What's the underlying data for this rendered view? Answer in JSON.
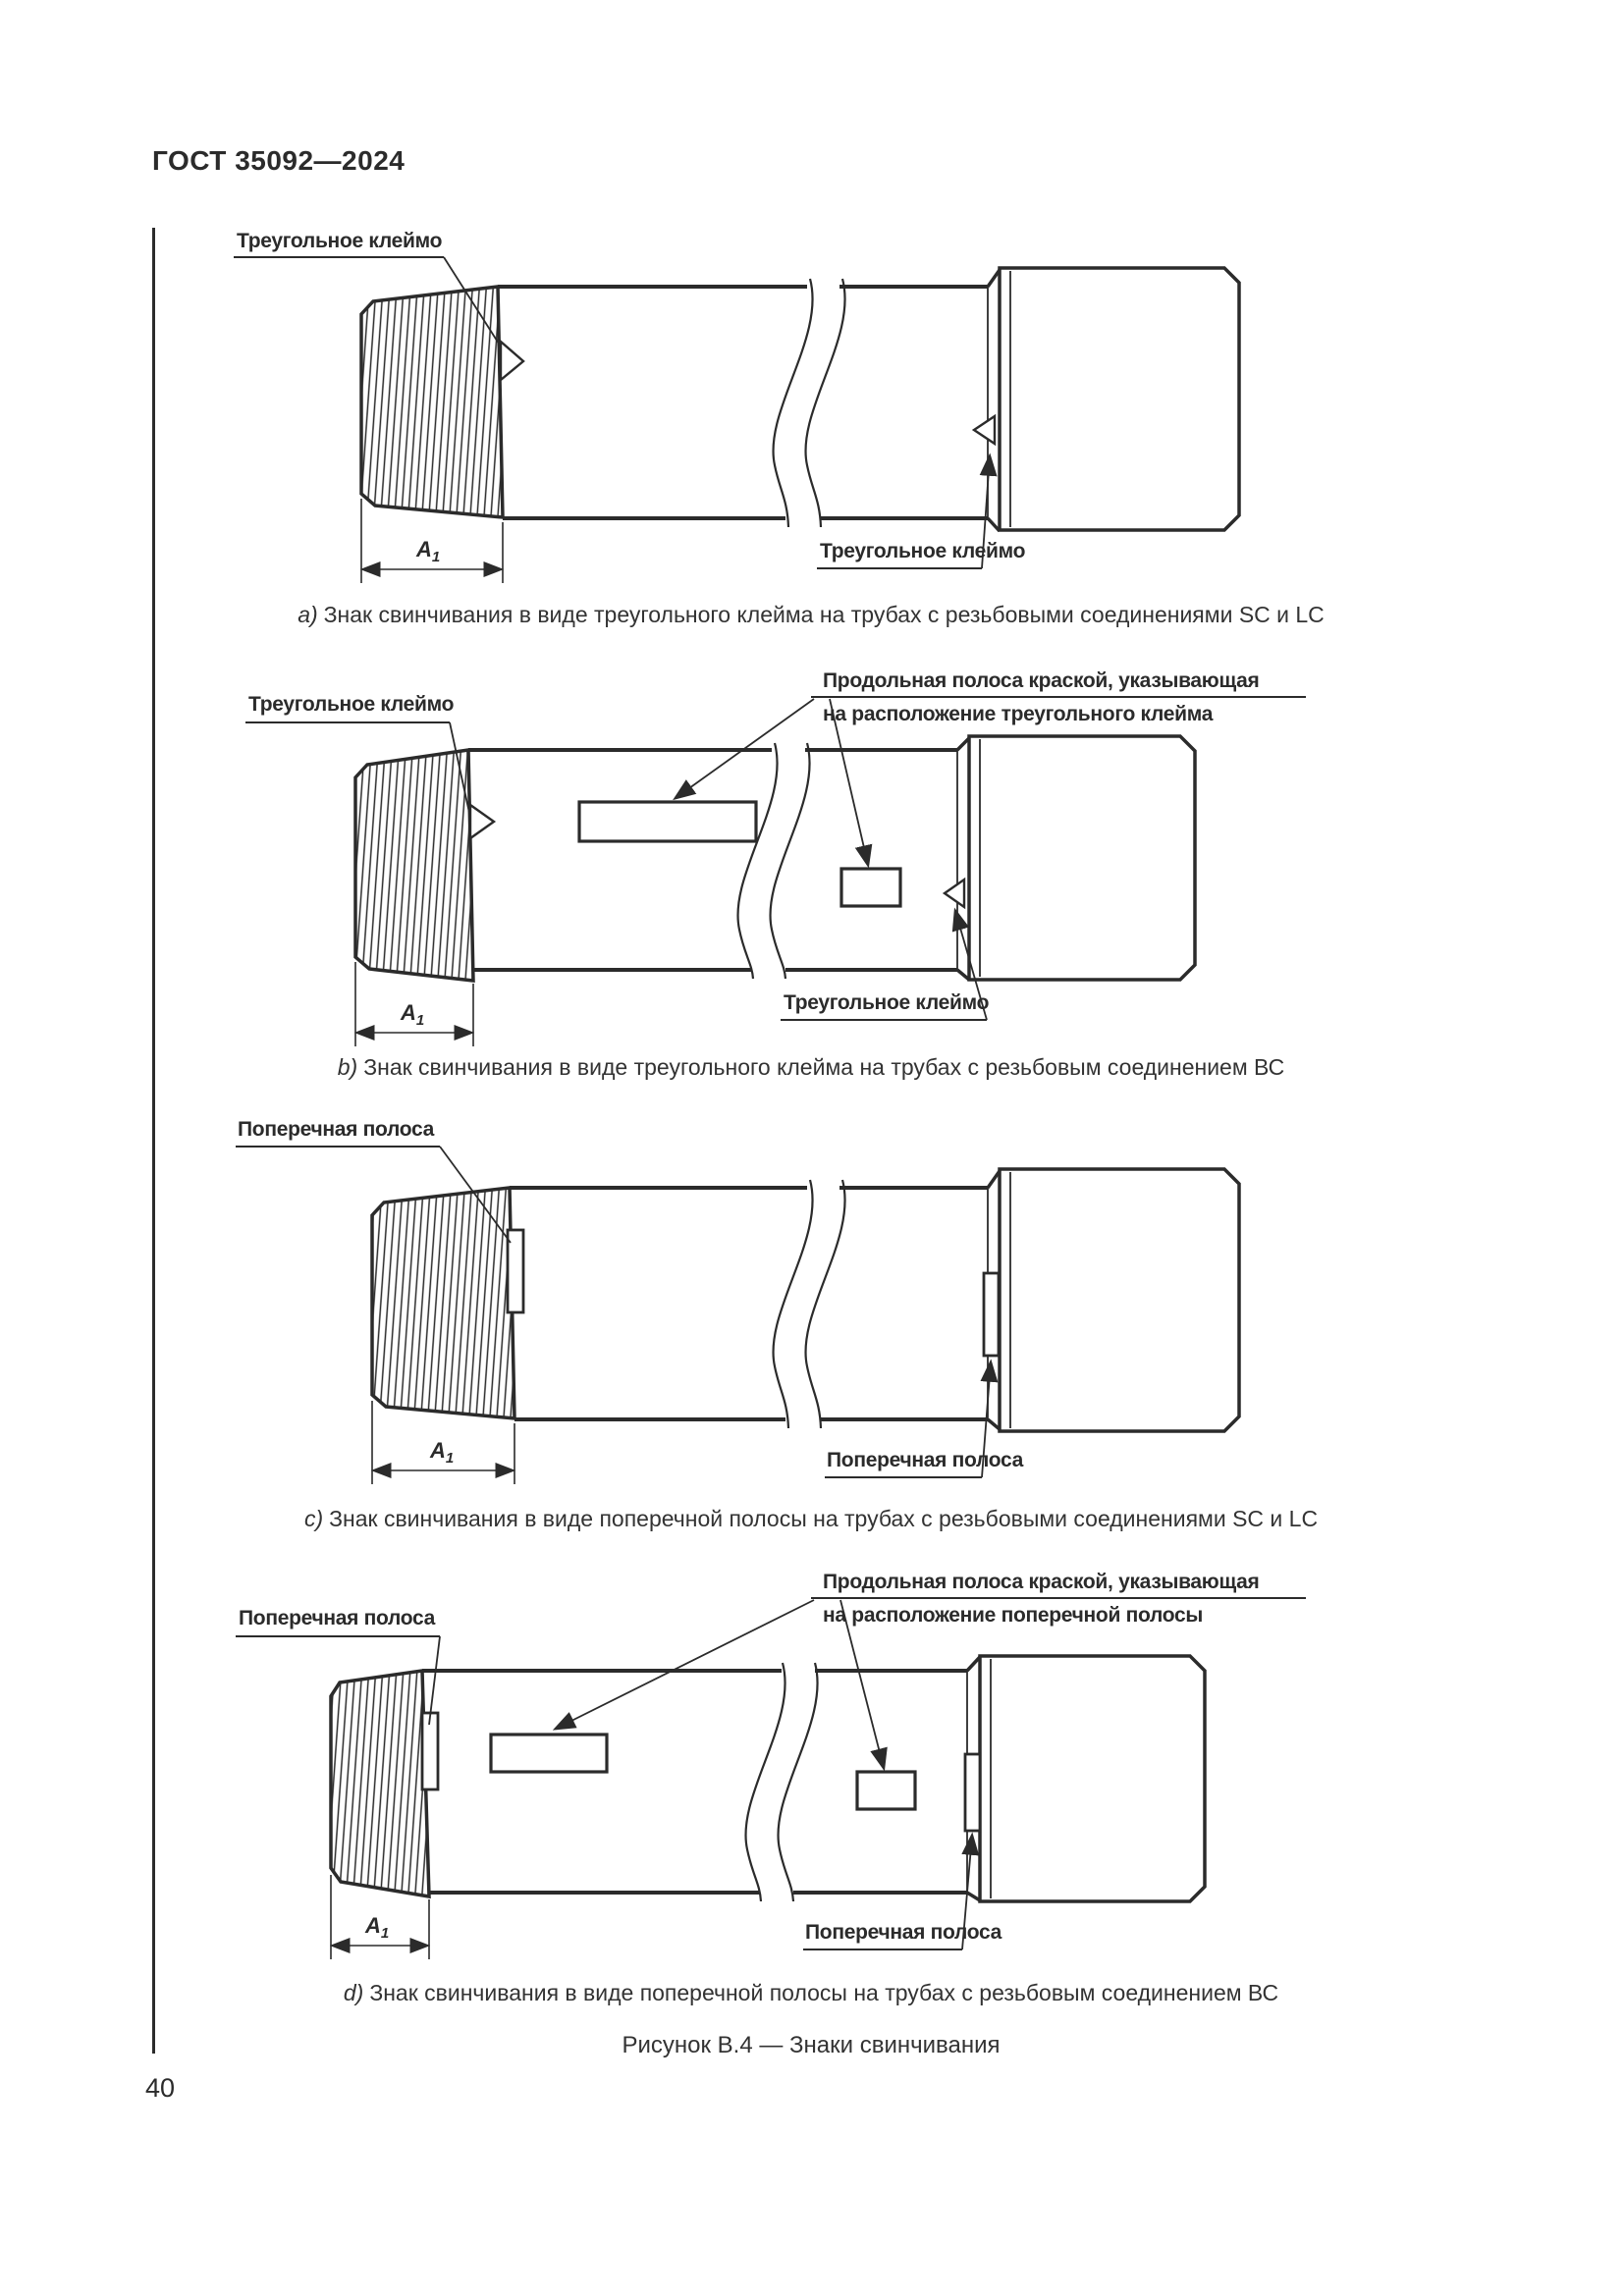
{
  "header": {
    "title": "ГОСТ 35092—2024"
  },
  "footer": {
    "page_number": "40"
  },
  "figure": {
    "caption": "Рисунок В.4 — Знаки свинчивания"
  },
  "dim": {
    "main": "A",
    "sub": "1"
  },
  "labels": {
    "triangle_mark": "Треугольное клеймо",
    "transverse_stripe": "Поперечная полоса",
    "longitudinal_line1": "Продольная полоса краской, указывающая",
    "longitudinal_line2_triangle": "на расположение треугольного клейма",
    "longitudinal_line2_stripe": "на расположение поперечной полосы"
  },
  "captions": {
    "a": {
      "letter": "a)",
      "text": "Знак свинчивания в виде треугольного клейма на трубах с резьбовыми соединениями SC и LC"
    },
    "b": {
      "letter": "b)",
      "text": "Знак свинчивания в виде треугольного клейма на трубах с резьбовым соединением ВС"
    },
    "c": {
      "letter": "c)",
      "text": "Знак свинчивания в виде поперечной полосы на трубах с резьбовыми соединениями SC и LC"
    },
    "d": {
      "letter": "d)",
      "text": "Знак свинчивания в виде поперечной полосы на трубах с резьбовым соединением ВС"
    }
  }
}
